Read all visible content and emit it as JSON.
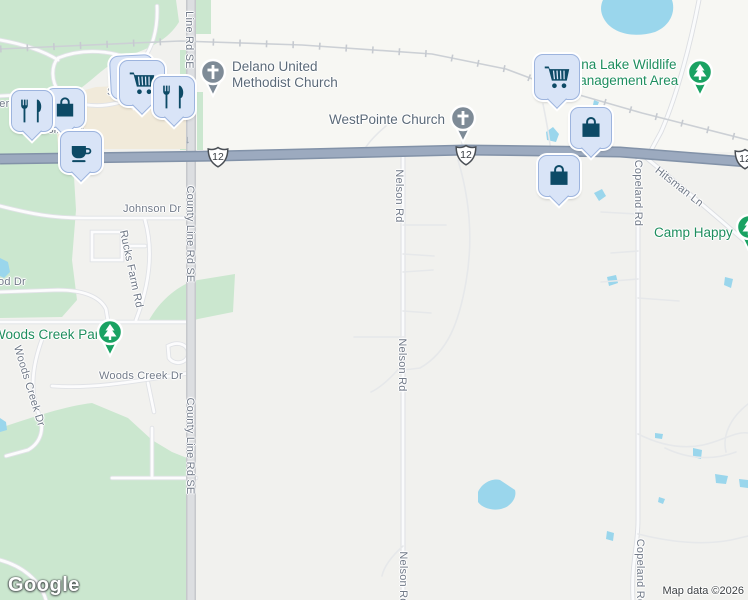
{
  "map": {
    "provider_logo": "Google",
    "attribution": "Map data ©2026",
    "route_shield_label": "12",
    "icons": {
      "down_arrow": "↓"
    },
    "street_labels": {
      "county_line_top": "Line Rd SE",
      "county_line_mid": "County Line Rd SE",
      "county_line_bottom": "County Line Rd SE",
      "nelson_1": "Nelson Rd",
      "nelson_2": "Nelson Rd",
      "nelson_3": "Nelson Rd",
      "copeland_1": "Copeland Rd",
      "copeland_2": "Copeland Rd",
      "hitsman": "Hitsman Ln",
      "johnson": "Johnson Dr",
      "rucks_farm": "Rucks Farm Rd",
      "od_dr_fragment": "od Dr",
      "woods_creek_dr_horizontal": "Woods Creek Dr",
      "woods_creek_dr_diagonal": "Woods Creek Dr",
      "crossing_dr_partial": "Crossing Dr",
      "ter_fragment": "ter",
      "s_fragment": "S"
    },
    "pois": {
      "delano_line1": "Delano United",
      "delano_line2": "Methodist Church",
      "westpointe": "WestPointe Church",
      "china_lake_line1": "China Lake Wildlife",
      "china_lake_line2": "Management Area",
      "camp_happy": "Camp Happy",
      "woods_creek_park": "Woods Creek Park"
    },
    "markers": [
      {
        "icon": "shopping-bag-icon"
      },
      {
        "icon": "restaurant-icon"
      },
      {
        "icon": "shopping-cart-icon"
      },
      {
        "icon": "shopping-cart-icon"
      },
      {
        "icon": "restaurant-icon"
      },
      {
        "icon": "coffee-icon"
      },
      {
        "icon": "shopping-cart-icon"
      },
      {
        "icon": "shopping-bag-icon"
      },
      {
        "icon": "shopping-bag-icon"
      }
    ],
    "colors": {
      "park_green_fill": "#cbe7cf",
      "water": "#9ad6ec",
      "highway": "#9caabf",
      "commercial_area": "#f1eada",
      "marker_glyph": "#0d4a66",
      "marker_balloon": "#d9e4f7",
      "poi_label_green": "#1e8e5e",
      "church_pin_gray": "#7e8b97",
      "park_pin_green": "#1aa262"
    }
  }
}
